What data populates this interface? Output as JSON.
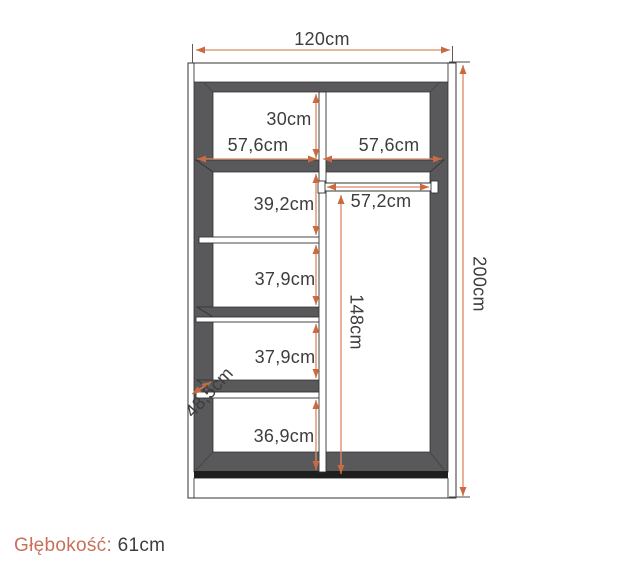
{
  "colors": {
    "arrow_head": "#c96a40",
    "arrow_line": "#d98a64",
    "panel_gray": "#59595b",
    "plinth_black": "#1e1e1f",
    "outline": "#333333",
    "label_text": "#3d3d3d",
    "accent_text": "#c9705a"
  },
  "dimensions": {
    "overall_width": "120cm",
    "overall_height": "200cm",
    "top_shelf_height": "30cm",
    "left_section_width": "57,6cm",
    "right_section_width": "57,6cm",
    "shelf_gap_1": "39,2cm",
    "rail_length": "57,2cm",
    "hanging_space_height": "148cm",
    "shelf_gap_2": "37,9cm",
    "shelf_gap_3": "37,9cm",
    "bottom_section_height": "36,9cm",
    "interior_depth": "48,5cm"
  },
  "footer": {
    "depth_label": "Głębokość:",
    "depth_value": "61cm"
  }
}
